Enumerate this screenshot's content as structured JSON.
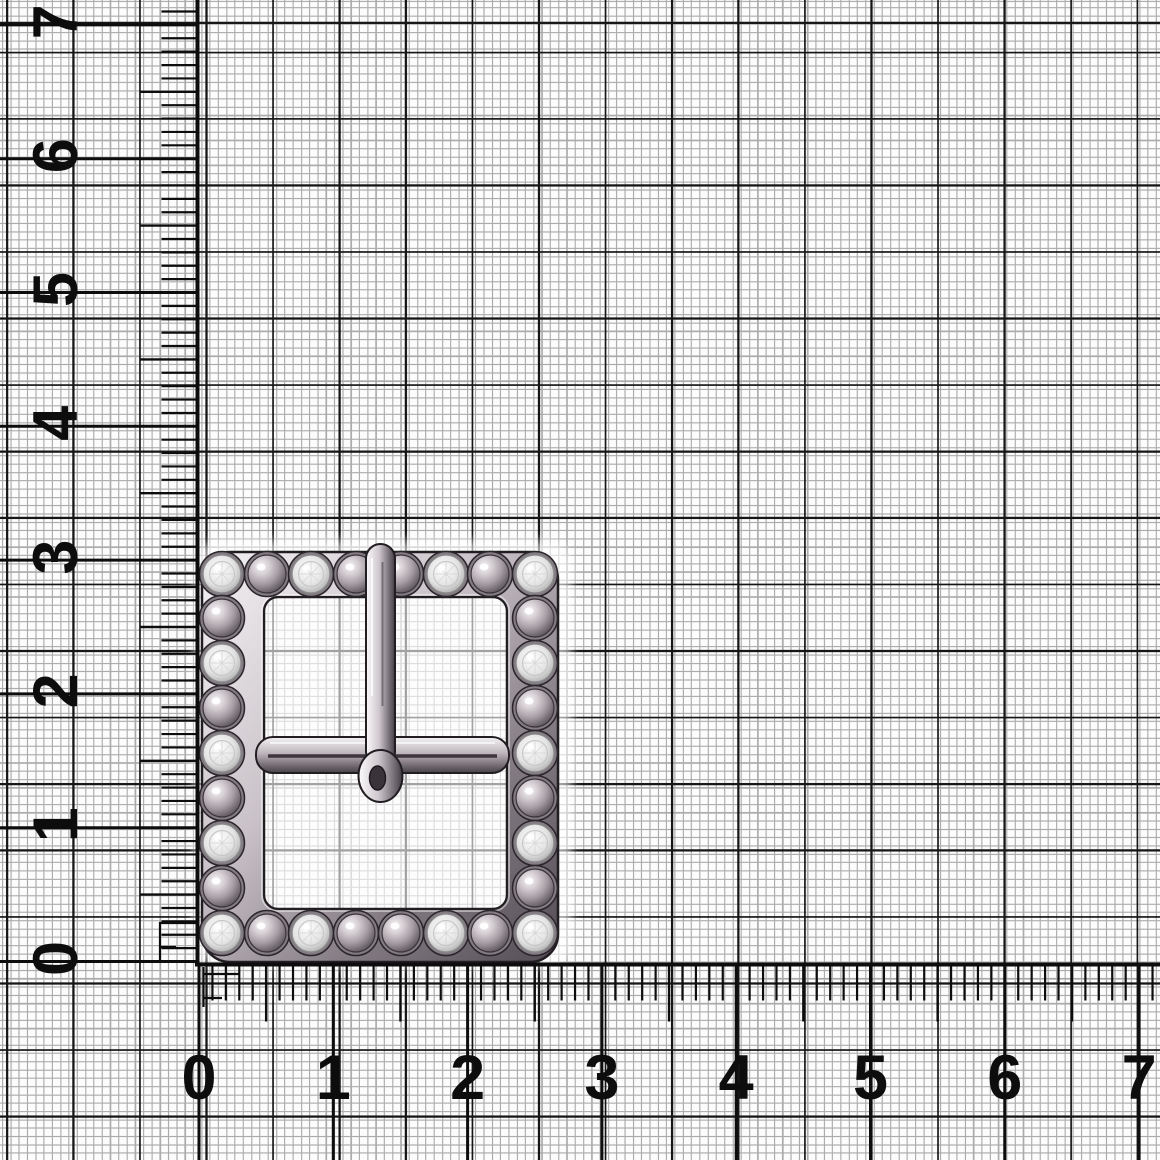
{
  "scene": {
    "width": 1160,
    "height": 1160,
    "background": "#fcfcfc"
  },
  "grid": {
    "minor_spacing_px": 8.3,
    "major_spacing_px": 66.5,
    "minor_color": "#ababab",
    "major_color": "#161616"
  },
  "rulers": {
    "color": "#0d0d0d",
    "origin_x": 199,
    "origin_y": 961.5,
    "unit_px_horizontal": 134.3,
    "unit_px_vertical": 133.8,
    "mm_tick_len": 36,
    "half_tick_len": 57,
    "label_font_px": 63,
    "vertical": {
      "labels": [
        "0",
        "1",
        "2",
        "3",
        "4",
        "5",
        "6",
        "7"
      ],
      "line_x": 197.5,
      "label_x": 56
    },
    "horizontal": {
      "labels": [
        "0",
        "1",
        "2",
        "3",
        "4",
        "5",
        "6",
        "7"
      ],
      "line_y": 964.5,
      "label_y": 1078
    }
  },
  "buckle": {
    "name": "square-rhinestone-buckle",
    "halo": {
      "x": 194,
      "y": 540,
      "w": 378,
      "h": 426,
      "rx": 24,
      "opacity": 0.6,
      "blur": 5
    },
    "frame": {
      "x": 202,
      "y": 552,
      "w": 356,
      "h": 410,
      "rx": 28
    },
    "window": {
      "x": 264,
      "y": 597,
      "w": 243,
      "h": 312,
      "rx": 14
    },
    "bar": {
      "x": 256,
      "y": 737,
      "w": 253,
      "h": 36,
      "rx": 17,
      "groove_y": 756
    },
    "prong": {
      "cx": 380.5,
      "shaft_w": 29,
      "top": 544,
      "shaft_bottom": 766,
      "tip_cy": 776,
      "tip_rx": 22,
      "tip_ry": 26,
      "hole_rx": 8,
      "hole_ry": 12
    },
    "stone_radius": 19,
    "bezel_radius": 22.5,
    "rows": {
      "top": {
        "y": 574,
        "xs": [
          222,
          267,
          311,
          356,
          401,
          446,
          490,
          535
        ],
        "types": [
          "S",
          "D",
          "S",
          "D",
          "D",
          "S",
          "D",
          "S"
        ]
      },
      "bottom": {
        "y": 933,
        "xs": [
          222,
          267,
          311,
          356,
          401,
          446,
          490,
          535
        ],
        "types": [
          "S",
          "D",
          "S",
          "D",
          "D",
          "S",
          "D",
          "S"
        ]
      },
      "left": {
        "x": 222,
        "ys": [
          618,
          663,
          708,
          753,
          798,
          843,
          888
        ],
        "types": [
          "D",
          "S",
          "D",
          "S",
          "D",
          "S",
          "D"
        ]
      },
      "right": {
        "x": 535,
        "ys": [
          618,
          663,
          708,
          753,
          798,
          843,
          888
        ],
        "types": [
          "D",
          "S",
          "D",
          "S",
          "D",
          "S",
          "D"
        ]
      }
    },
    "colors": {
      "metal_light": "#f4f2f4",
      "metal_mid": "#c9c2c8",
      "metal_deep": "#837b82",
      "metal_dark": "#544c54",
      "outline": "#211d21",
      "bezel": "#847c83",
      "stone_core": "#ffffff",
      "stone_mid": "#e3e3e3",
      "stone_edge": "#8d8d8d",
      "dome_light": "#f7f5f6",
      "dome_mid": "#a59da3",
      "dome_dark": "#4a434a",
      "halo": "#ffffff"
    }
  }
}
